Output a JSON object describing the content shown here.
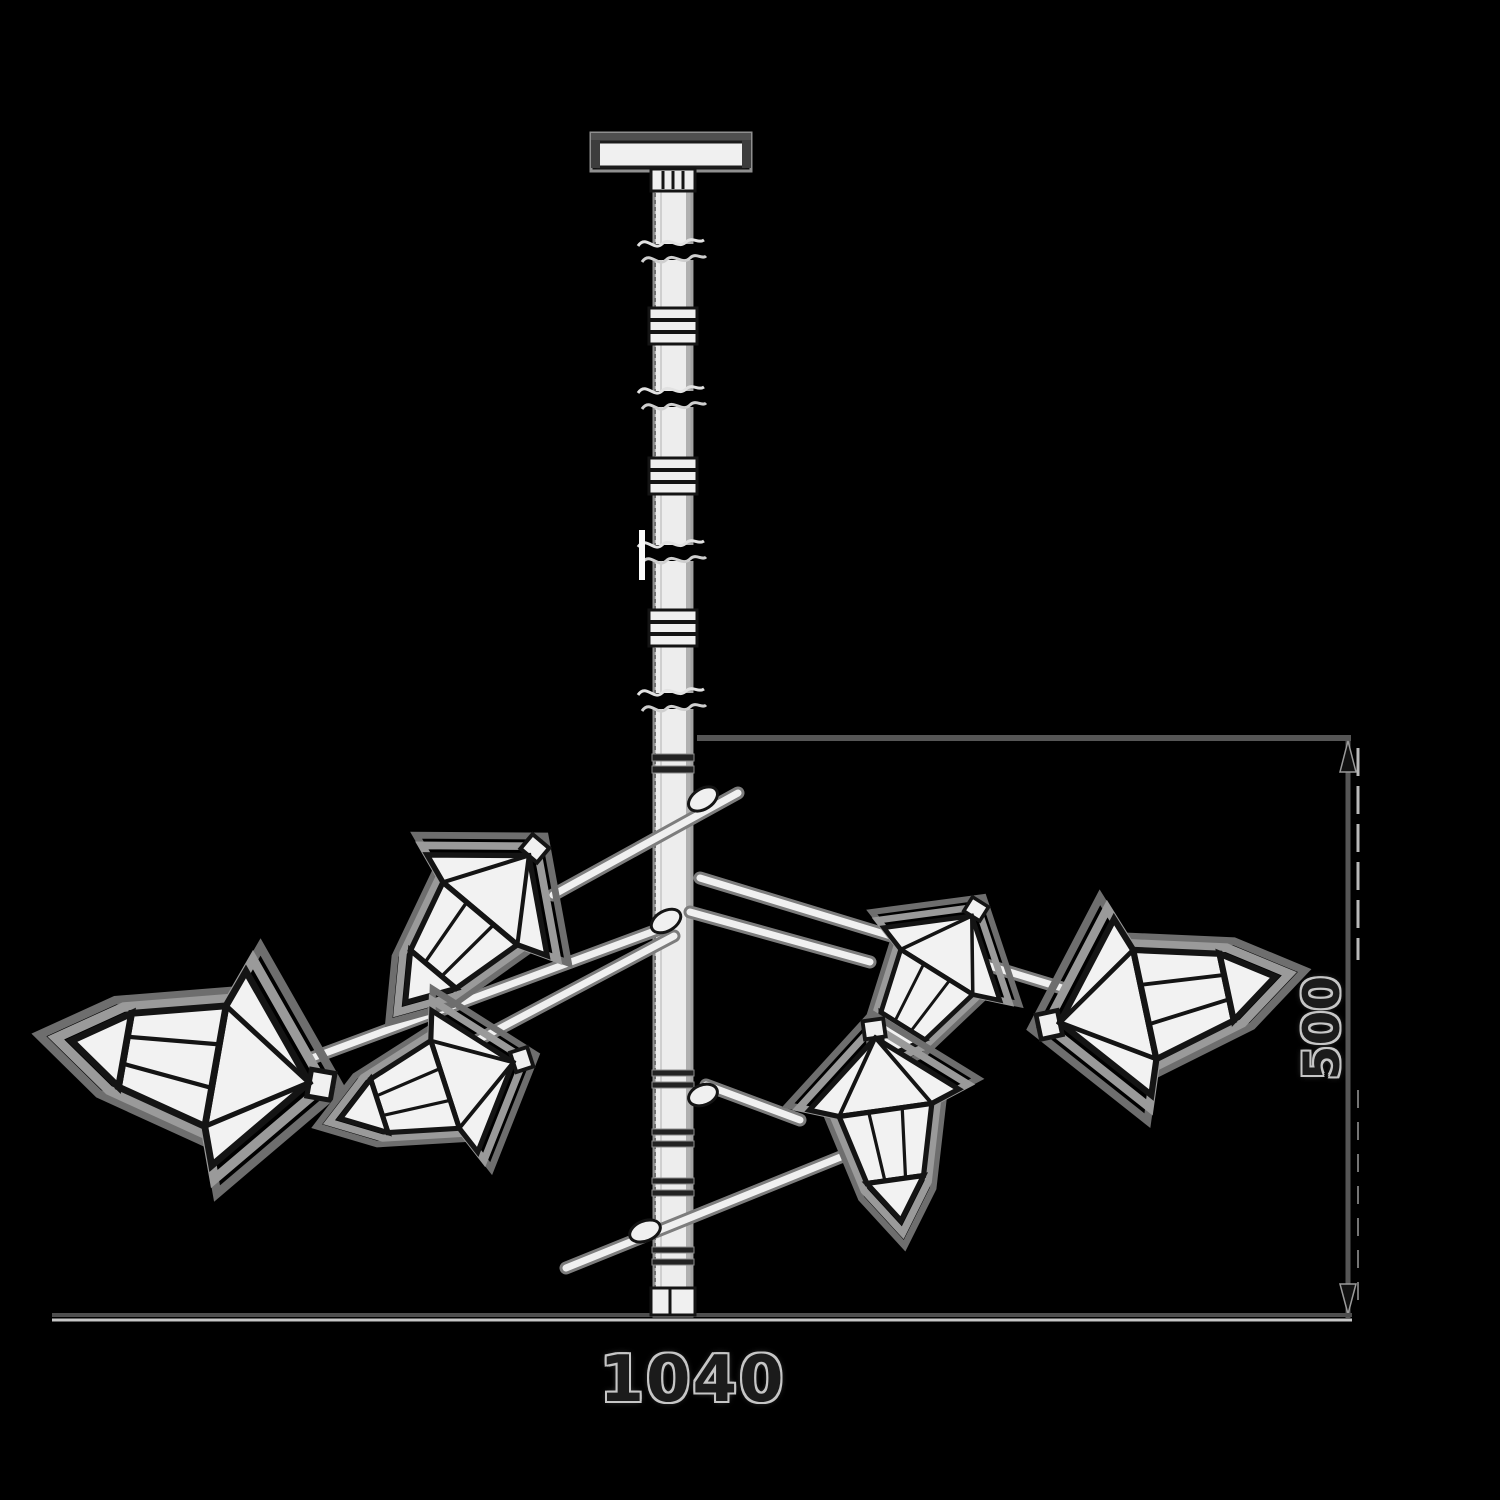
{
  "dimensions": {
    "width": "1040",
    "height": "500"
  },
  "colors": {
    "background": "#000000",
    "drawing_fill": "#f2f2f2",
    "drawing_ink": "#141414",
    "rim_gray": "#8f8f8f",
    "dimension_line": "#565656",
    "dimension_line_light": "#c6c6c6",
    "dimension_text": "#1b1b1b",
    "text_halo": "#c6c6c6"
  }
}
